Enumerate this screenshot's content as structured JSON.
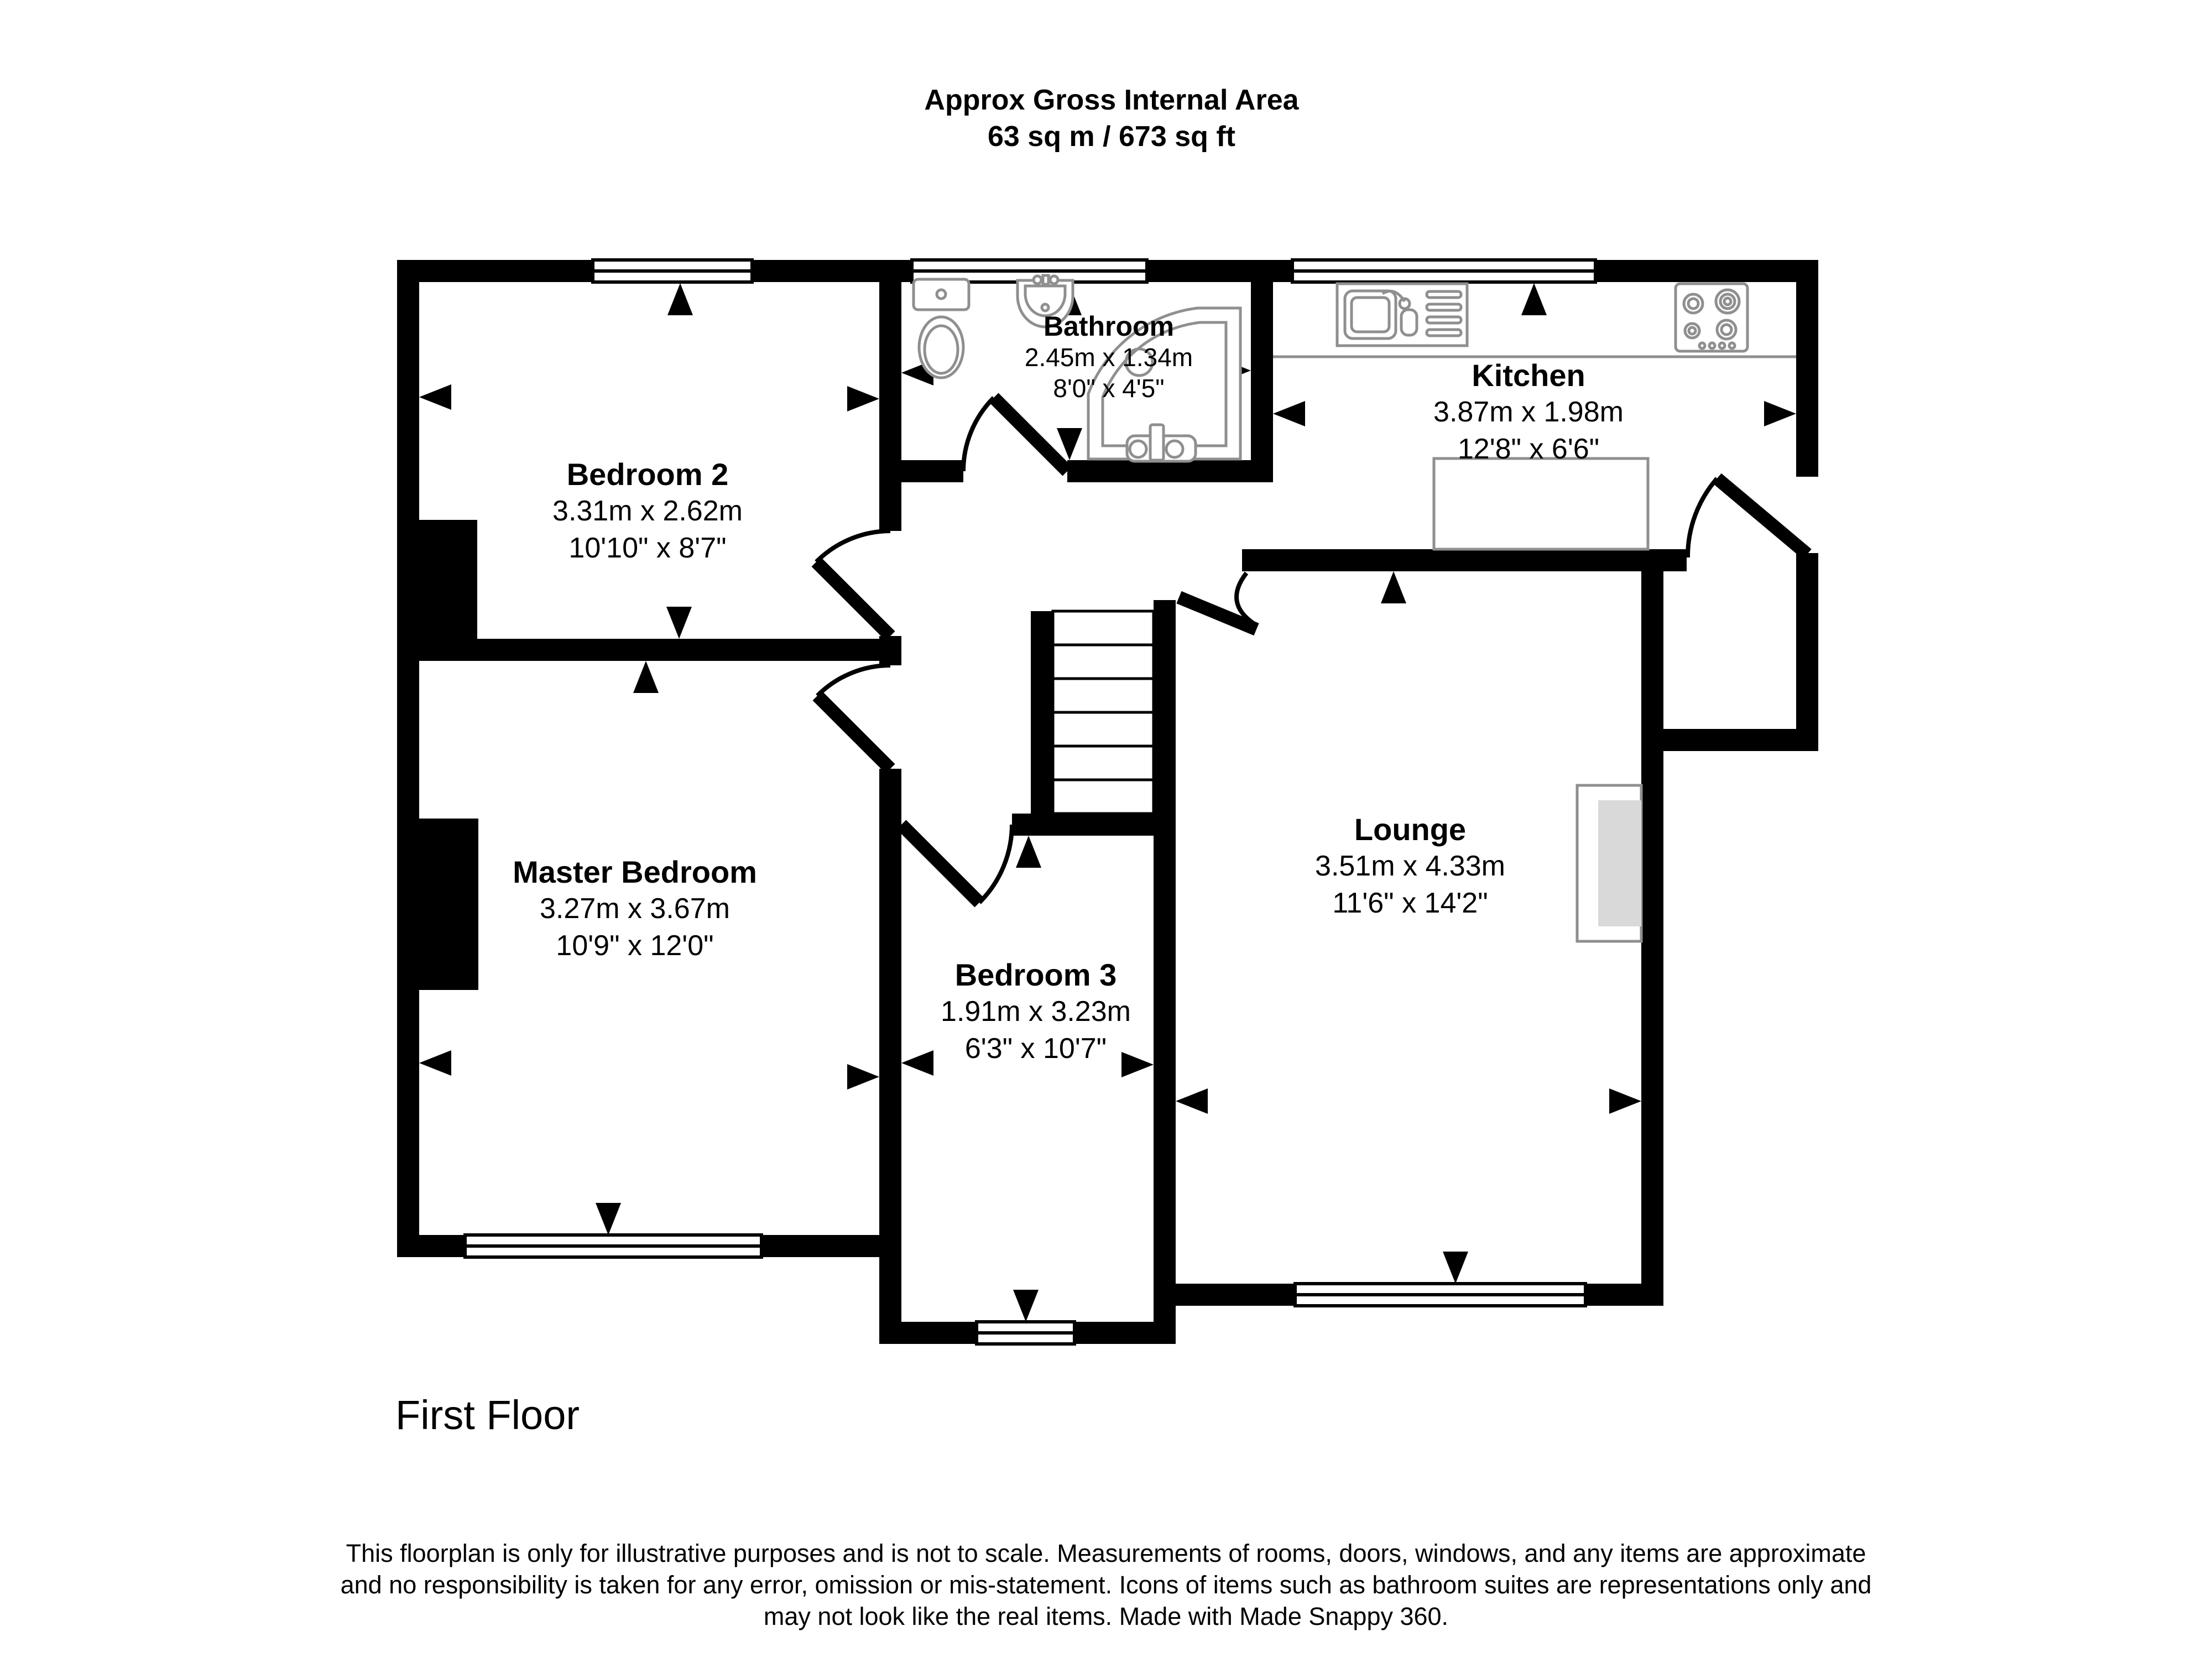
{
  "header": {
    "line1": "Approx Gross Internal Area",
    "line2": "63 sq m / 673 sq ft"
  },
  "rooms": {
    "bedroom2": {
      "name": "Bedroom 2",
      "metric": "3.31m x 2.62m",
      "imperial": "10'10\" x 8'7\""
    },
    "bathroom": {
      "name": "Bathroom",
      "metric": "2.45m x 1.34m",
      "imperial": "8'0\" x 4'5\""
    },
    "kitchen": {
      "name": "Kitchen",
      "metric": "3.87m x 1.98m",
      "imperial": "12'8\" x 6'6\""
    },
    "master": {
      "name": "Master Bedroom",
      "metric": "3.27m x 3.67m",
      "imperial": "10'9\" x 12'0\""
    },
    "bedroom3": {
      "name": "Bedroom 3",
      "metric": "1.91m x 3.23m",
      "imperial": "6'3\" x 10'7\""
    },
    "lounge": {
      "name": "Lounge",
      "metric": "3.51m x 4.33m",
      "imperial": "11'6\" x 14'2\""
    }
  },
  "floor_label": "First Floor",
  "disclaimer": {
    "line1": "This floorplan is only for illustrative purposes and is not to scale. Measurements of rooms, doors, windows, and any items are approximate",
    "line2": "and no responsibility is taken for any error, omission or mis-statement. Icons of items such as bathroom suites are representations only and",
    "line3": "may not look like the real items. Made with Made Snappy 360."
  },
  "colors": {
    "wall": "#000000",
    "background": "#ffffff",
    "fixture_outline": "#8f8f8f",
    "fireplace_fill": "#d9d9d9"
  }
}
